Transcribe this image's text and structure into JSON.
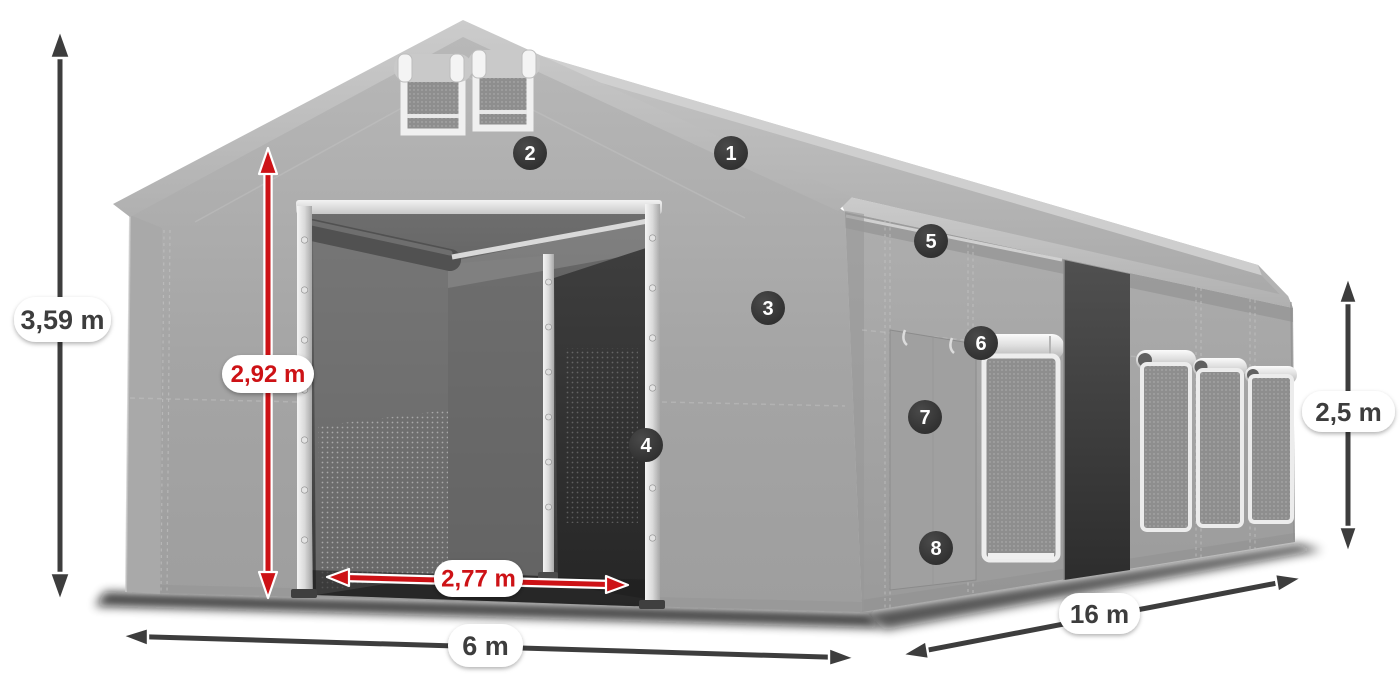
{
  "diagram": {
    "type": "tent-dimension-diagram",
    "dimension_annotations": [
      {
        "id": "total_height",
        "label": "3,59 m",
        "style": "dark",
        "orientation": "vertical"
      },
      {
        "id": "entrance_height",
        "label": "2,92 m",
        "style": "red",
        "orientation": "vertical"
      },
      {
        "id": "entrance_width",
        "label": "2,77 m",
        "style": "red",
        "orientation": "horizontal"
      },
      {
        "id": "width",
        "label": "6 m",
        "style": "dark",
        "orientation": "horizontal"
      },
      {
        "id": "length",
        "label": "16 m",
        "style": "dark",
        "orientation": "diagonal"
      },
      {
        "id": "side_height",
        "label": "2,5 m",
        "style": "dark",
        "orientation": "vertical"
      }
    ],
    "feature_markers": [
      {
        "number": "1"
      },
      {
        "number": "2"
      },
      {
        "number": "3"
      },
      {
        "number": "4"
      },
      {
        "number": "5"
      },
      {
        "number": "6"
      },
      {
        "number": "7"
      },
      {
        "number": "8"
      }
    ],
    "colors": {
      "dimension_dark": "#3d3d3d",
      "accent_red": "#cd1216",
      "marker_background": "#333333",
      "marker_text": "#ffffff",
      "tent_fabric": "#a8a8a8",
      "background": "#ffffff"
    }
  }
}
